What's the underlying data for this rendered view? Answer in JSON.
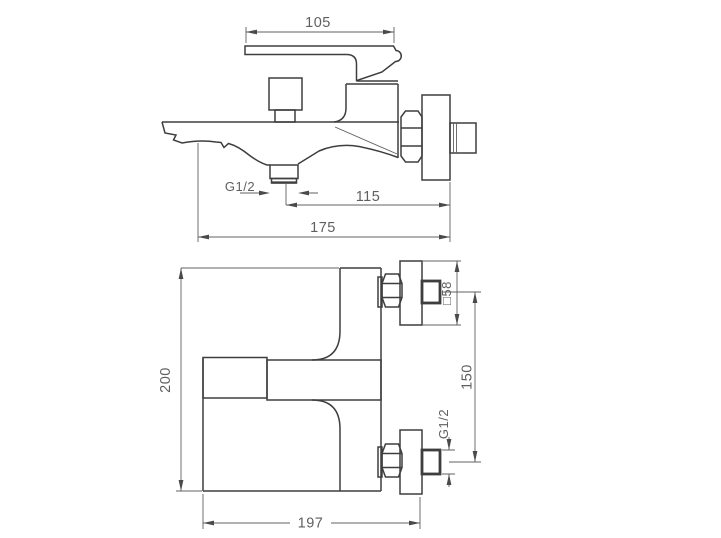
{
  "colors": {
    "background": "#ffffff",
    "outline": "#3e3e3e",
    "dimension_lines": "#606060",
    "dimension_text": "#5f5f5f"
  },
  "views": {
    "side": {
      "dims": {
        "lever_length": "105",
        "outlet_thread": "G1/2",
        "outlet_to_wall": "115",
        "overall_reach": "175"
      }
    },
    "plan": {
      "dims": {
        "overall_width": "200",
        "overall_length": "197",
        "inlet_spacing": "150",
        "escutcheon": "□58",
        "inlet_thread": "G1/2"
      }
    }
  }
}
